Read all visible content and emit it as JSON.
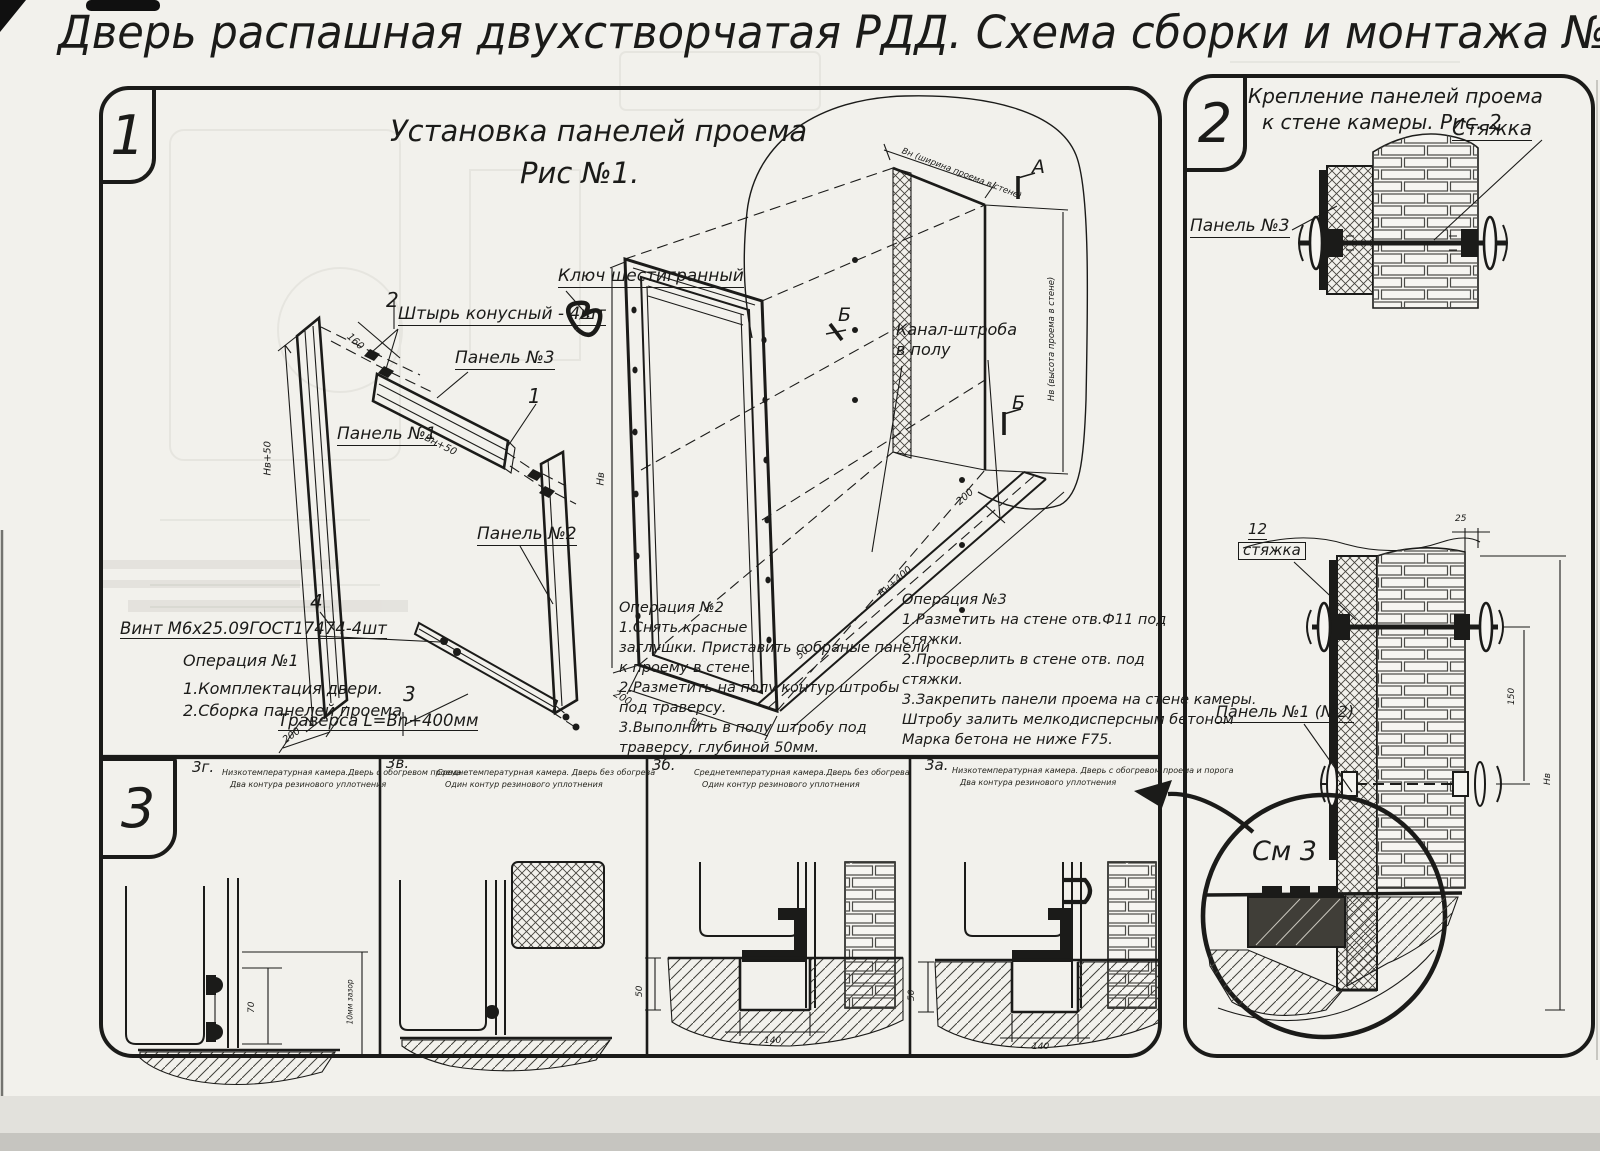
{
  "page": {
    "title": "Дверь распашная двухстворчатая РДД.  Схема сборки и монтажа №2"
  },
  "fig1": {
    "badge": "1",
    "title1": "Установка панелей проема",
    "title2": "Рис №1.",
    "callouts": {
      "hex_key": "Ключ шестигранный",
      "pin_no": "2",
      "pin": "Штырь конусный - 4шт",
      "panel3": "Панель №3",
      "panel3_no": "1",
      "panel1": "Панель №1",
      "panel2": "Панель №2",
      "screw_no": "4",
      "screw": "Винт М6х25.09ГОСТ17474-4шт",
      "traverse_no": "3",
      "traverse": "Траверса  L=Bn+400мм",
      "channel1": "Канал-штроба",
      "channel2": "в полу",
      "marker_a": "А",
      "marker_b": "Б",
      "marker_b_frame": "Б"
    },
    "op1": [
      "Операция №1",
      "1.Комплектация двери.",
      "2.Сборка панелей проема"
    ],
    "op2": [
      "Операция №2",
      "1.Снять красные",
      "заглушки. Приставить собраные панели",
      "к проему в стене.",
      "2.Разметить на полу контур штробы",
      "под траверсу.",
      "3.Выполнить в полу штробу под",
      "траверсу, глубиной 50мм."
    ],
    "op3": [
      "Операция №3",
      "1.Разметить на стене отв.Ф11 под",
      "стяжки.",
      "2.Просверлить в стене отв.  под",
      "стяжки.",
      "3.Закрепить панели проема на стене камеры.",
      "Штробу залить мелкодисперсным бетоном",
      "Марка бетона не ниже  F75."
    ],
    "dims": {
      "panel1_h": "Нв+50",
      "panel1_w": "200",
      "pin_gap": "160",
      "panel3_l": "Вн+50",
      "frame_h": "Нв",
      "frame_w": "Вн",
      "frame_200a": "200",
      "frame_200b": "200",
      "frame_50": "50",
      "trench": "Вн+400",
      "wall_w": "Вн (ширина проема в стене)",
      "wall_h": "Нв (высота проема в стене)"
    }
  },
  "fig2": {
    "badge": "2",
    "title1": "Крепление панелей проема",
    "title2": "к стене камеры. Рис. 2",
    "tie": "Стяжка",
    "panel3": "Панель №3",
    "pos_no": "12",
    "pos": "стяжка",
    "panel12": "Панель №1 (№2)",
    "see": "См 3",
    "dims": {
      "d25": "25",
      "d150": "150",
      "dh": "Нв"
    }
  },
  "fig3": {
    "badge": "3",
    "items": [
      {
        "id": "3г.",
        "d1": "Низкотемпературная камера.Дверь с обогревом проема",
        "d2": "Два контура резинового уплотнения",
        "dimA": "70",
        "dimB": "10мм зазор"
      },
      {
        "id": "3в.",
        "d1": "Среднетемпературная камера. Дверь без обогрева",
        "d2": "Один контур резинового уплотнения",
        "dimA": "",
        "dimB": ""
      },
      {
        "id": "3б.",
        "d1": "Среднетемпературная камера.Дверь без обогрева",
        "d2": "Один контур резинового уплотнения",
        "dimA": "50",
        "dimB": "140"
      },
      {
        "id": "3а.",
        "d1": "Низкотемпературная камера. Дверь с обогревом проема и порога",
        "d2": "Два контура резинового уплотнения",
        "dimA": "50",
        "dimB": "140"
      }
    ]
  }
}
